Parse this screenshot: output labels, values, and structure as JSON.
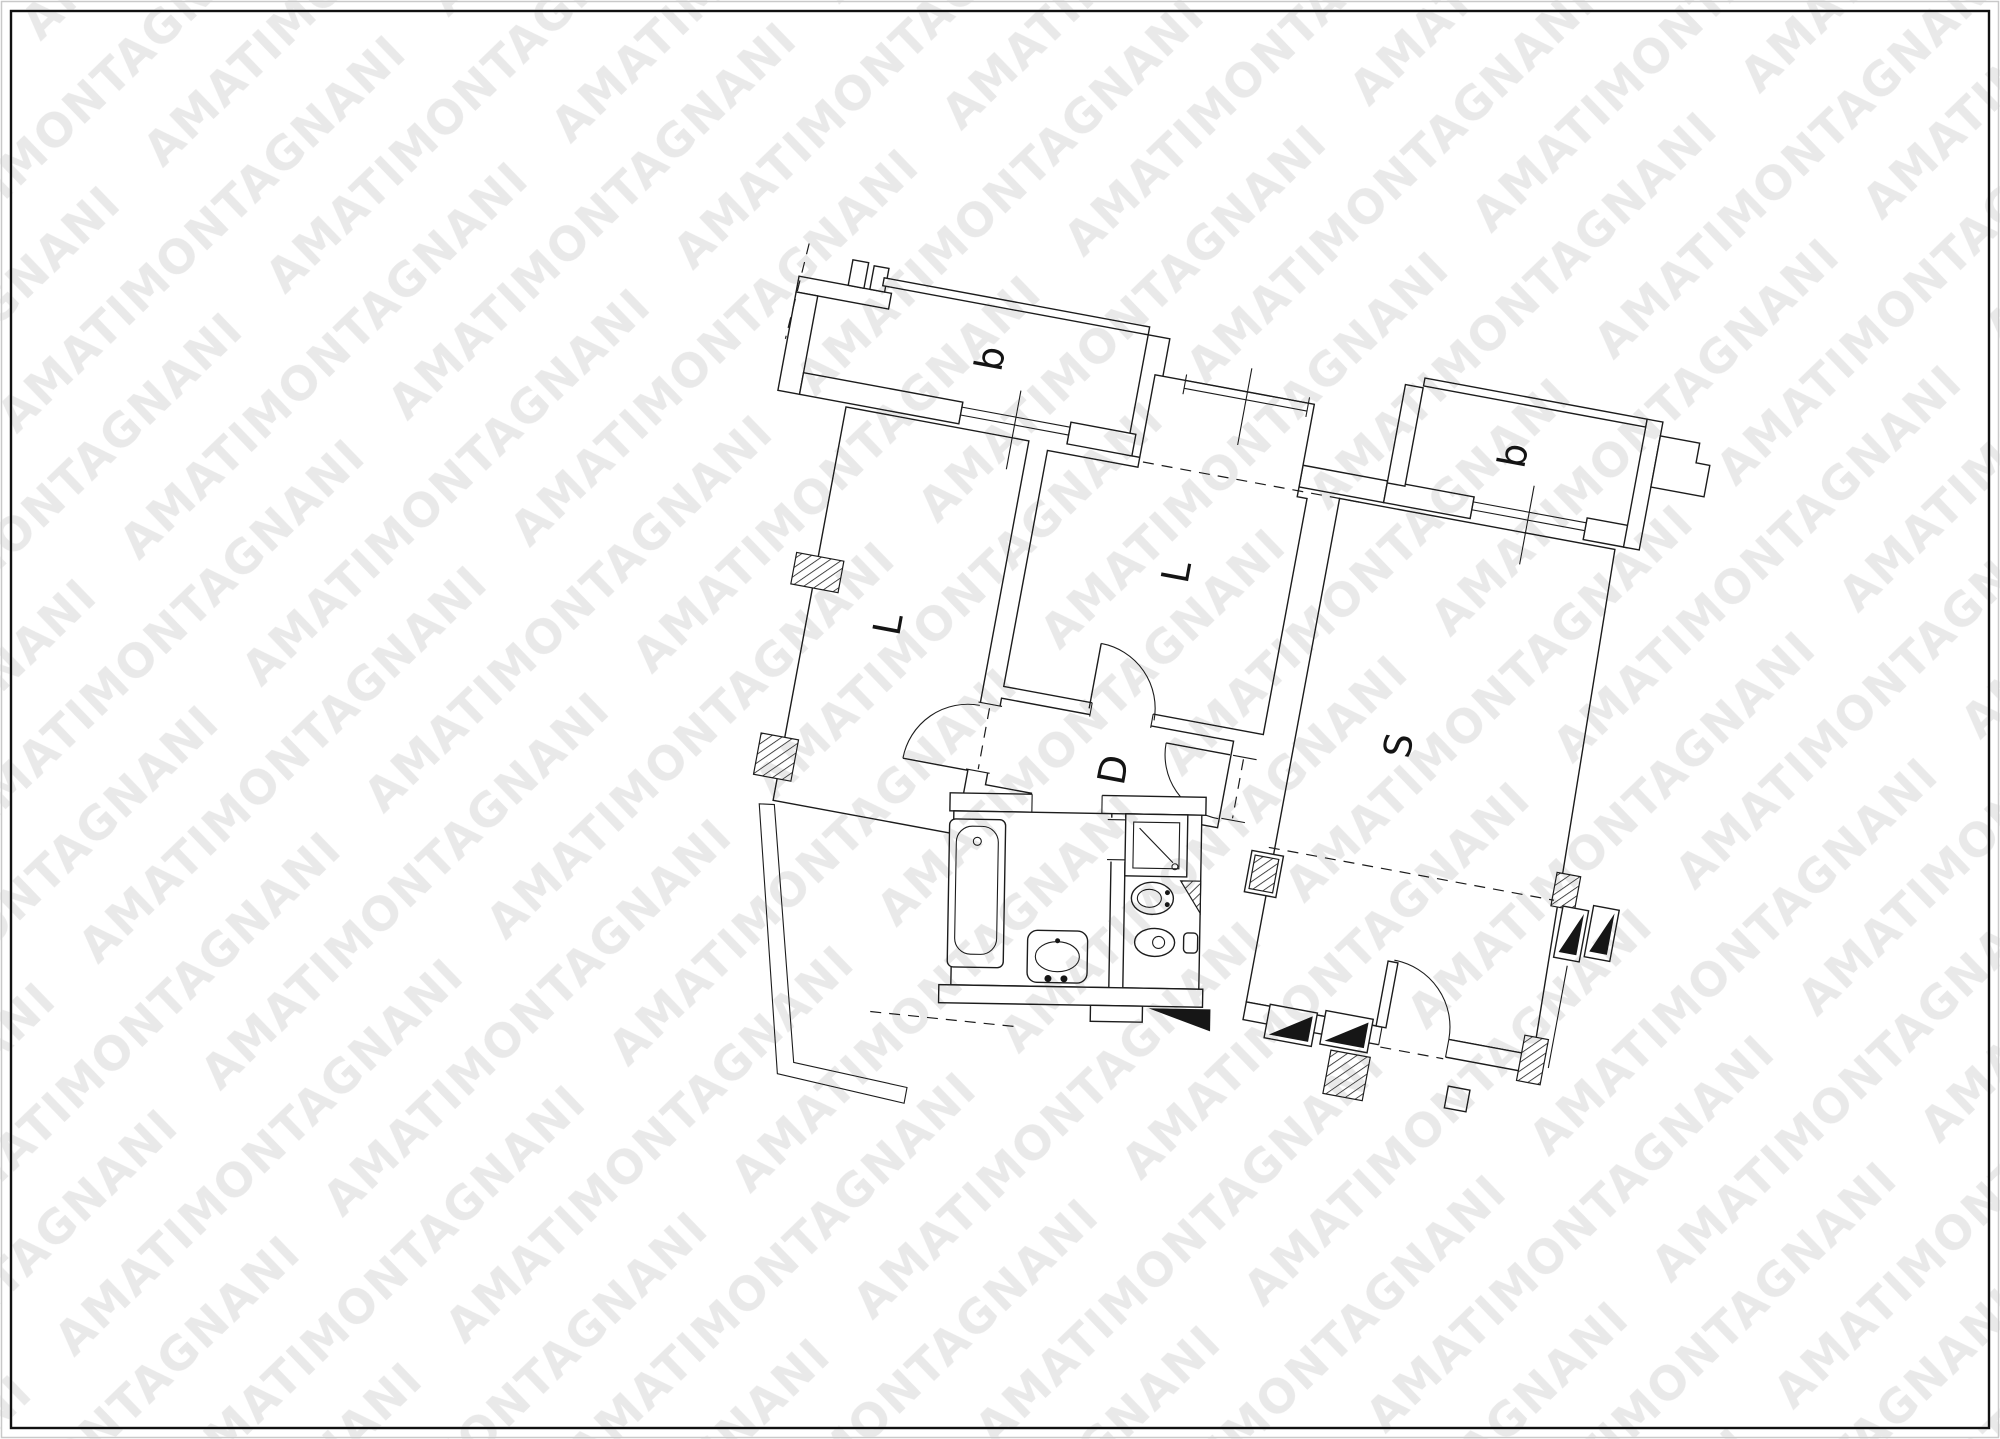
{
  "page": {
    "background": "#ffffff",
    "border_color": "#111111",
    "edge_color": "#c9c9c9"
  },
  "watermark": {
    "text": "AMATIMONTAGNANI",
    "color": "#e9e9e9",
    "angle_deg": -44
  },
  "floorplan": {
    "type": "apartment plan, rotated drawing",
    "rotation_deg": 10.5,
    "line_color": "#1c1c1c",
    "labels": {
      "balcony_left": "b",
      "balcony_right": "b",
      "room_left": "L",
      "room_center": "L",
      "soggiorno": "S",
      "disimpegno": "D"
    },
    "features": [
      "two balconies with thin parapets and windows",
      "three rooms L, L, S and hallway D",
      "two bathrooms: bathtub+sink, shower+wc+bidet",
      "entrance door with quarter-circle swing at lower right",
      "hatched wall piers, black stair triangles, dashed property lines"
    ]
  }
}
